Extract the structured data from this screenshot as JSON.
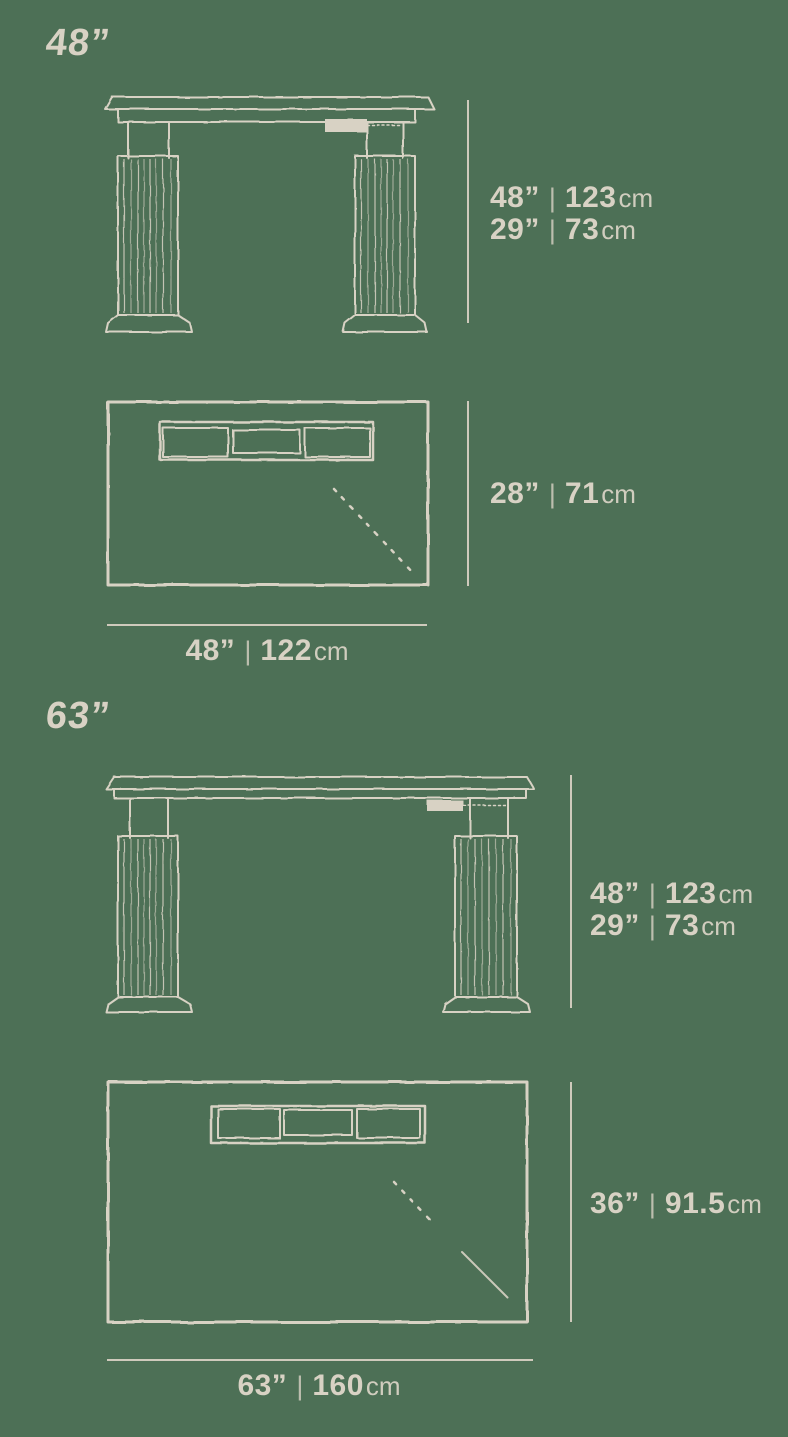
{
  "page": {
    "background_color": "#4d7056",
    "ink_color": "#d8d2c4"
  },
  "sections": [
    {
      "heading": "48”",
      "front": {
        "rows": [
          {
            "inches": "48”",
            "sep": "|",
            "value": "123",
            "unit": "cm"
          },
          {
            "inches": "29”",
            "sep": "|",
            "value": "73",
            "unit": "cm"
          }
        ]
      },
      "top": {
        "depth": {
          "inches": "28”",
          "sep": "|",
          "value": "71",
          "unit": "cm"
        },
        "width": {
          "inches": "48”",
          "sep": "|",
          "value": "122",
          "unit": "cm"
        }
      }
    },
    {
      "heading": "63”",
      "front": {
        "rows": [
          {
            "inches": "48”",
            "sep": "|",
            "value": "123",
            "unit": "cm"
          },
          {
            "inches": "29”",
            "sep": "|",
            "value": "73",
            "unit": "cm"
          }
        ]
      },
      "top": {
        "depth": {
          "inches": "36”",
          "sep": "|",
          "value": "91.5",
          "unit": "cm"
        },
        "width": {
          "inches": "63”",
          "sep": "|",
          "value": "160",
          "unit": "cm"
        }
      }
    }
  ]
}
